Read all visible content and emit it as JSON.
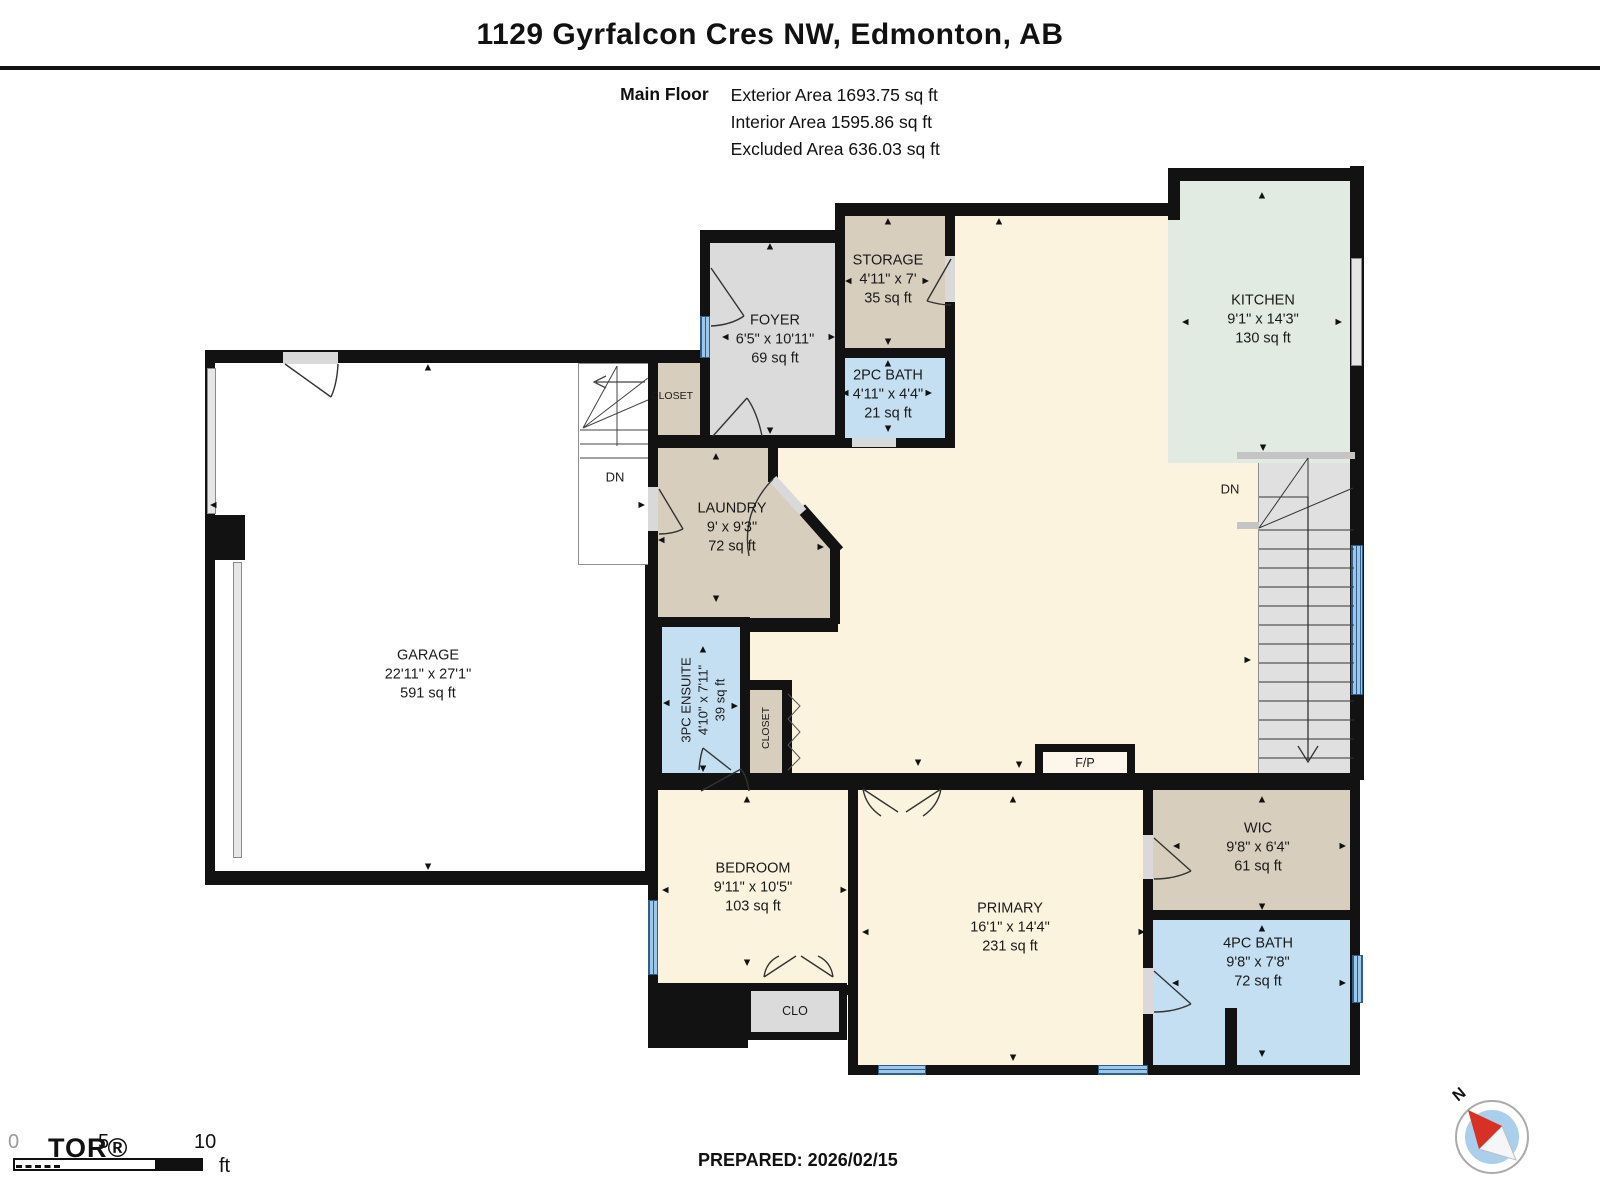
{
  "header": {
    "title": "1129 Gyrfalcon Cres NW, Edmonton, AB",
    "floor_label": "Main Floor",
    "areas": [
      "Exterior Area 1693.75 sq ft",
      "Interior Area 1595.86 sq ft",
      "Excluded Area 636.03 sq ft"
    ]
  },
  "colors": {
    "wall": "#121212",
    "cream": "#FBF3DD",
    "tan": "#D8CEBD",
    "gray_room": "#DBDBDB",
    "blue_room": "#C4DFF1",
    "mint": "#E1EBE2",
    "stairs": "#E0E0E0",
    "window_blue": "#9CC7E8"
  },
  "plan": {
    "rooms": [
      {
        "id": "family-base",
        "x": 845,
        "y": 203,
        "w": 420,
        "h": 585,
        "fill": "#FBF3DD",
        "b": [
          13,
          0,
          0,
          0
        ],
        "label": null
      },
      {
        "id": "family-west-base",
        "x": 648,
        "y": 438,
        "w": 300,
        "h": 350,
        "fill": "#FBF3DD",
        "b": [
          0,
          0,
          0,
          10
        ],
        "label": null
      },
      {
        "id": "garage",
        "x": 205,
        "y": 350,
        "w": 450,
        "h": 535,
        "fill": "#FFFFFF",
        "b": [
          13,
          10,
          14,
          10
        ],
        "label": {
          "name": "GARAGE",
          "dims": "22'11\" x 27'1\"",
          "area": "591 sq ft",
          "cx": 428,
          "cy": 675
        }
      },
      {
        "id": "garage-stairs",
        "x": 578,
        "y": 363,
        "w": 72,
        "h": 202,
        "fill": "#FFFFFF",
        "thin": true,
        "label": null
      },
      {
        "id": "stairs-down",
        "x": 1258,
        "y": 455,
        "w": 97,
        "h": 330,
        "fill": "#E0E0E0",
        "thin": true,
        "label": null
      },
      {
        "id": "kitchen",
        "x": 1168,
        "y": 168,
        "w": 192,
        "h": 295,
        "fill": "#E1EBE2",
        "b": [
          13,
          10,
          0,
          0
        ],
        "label": {
          "name": "KITCHEN",
          "dims": "9'1\" x 14'3\"",
          "area": "130 sq ft",
          "cx": 1263,
          "cy": 320
        }
      },
      {
        "id": "foyer",
        "x": 700,
        "y": 230,
        "w": 145,
        "h": 215,
        "fill": "#DBDBDB",
        "b": [
          13,
          10,
          10,
          10
        ],
        "label": {
          "name": "FOYER",
          "dims": "6'5\" x 10'11\"",
          "area": "69 sq ft",
          "cx": 775,
          "cy": 340
        }
      },
      {
        "id": "foyer-closet",
        "x": 648,
        "y": 350,
        "w": 52,
        "h": 95,
        "fill": "#D8CEBD",
        "b": [
          13,
          0,
          10,
          10
        ],
        "label": null
      },
      {
        "id": "storage",
        "x": 835,
        "y": 203,
        "w": 120,
        "h": 155,
        "fill": "#D8CEBD",
        "b": [
          13,
          10,
          10,
          10
        ],
        "label": {
          "name": "STORAGE",
          "dims": "4'11\" x 7'",
          "area": "35 sq ft",
          "cx": 888,
          "cy": 280
        }
      },
      {
        "id": "bath-2pc",
        "x": 835,
        "y": 348,
        "w": 120,
        "h": 100,
        "fill": "#C4DFF1",
        "b": [
          10,
          10,
          10,
          10
        ],
        "label": {
          "name": "2PC BATH",
          "dims": "4'11\" x 4'4\"",
          "area": "21 sq ft",
          "cx": 888,
          "cy": 395
        }
      },
      {
        "id": "laundry",
        "x": 648,
        "y": 438,
        "w": 190,
        "h": 194,
        "fill": "#D8CEBD",
        "b": [
          10,
          0,
          14,
          10
        ],
        "label": {
          "name": "LAUNDRY",
          "dims": "9' x 9'3\"",
          "area": "72 sq ft",
          "cx": 732,
          "cy": 528
        }
      },
      {
        "id": "ensuite-3pc",
        "x": 652,
        "y": 617,
        "w": 98,
        "h": 160,
        "fill": "#C4DFF1",
        "b": [
          10,
          10,
          0,
          10
        ],
        "label": {
          "name": "3PC ENSUITE",
          "dims": "4'10\" x 7'11\"",
          "area": "39 sq ft",
          "cx": 703,
          "cy": 700,
          "rot": true
        }
      },
      {
        "id": "closet-small",
        "x": 740,
        "y": 680,
        "w": 52,
        "h": 97,
        "fill": "#D8CEBD",
        "b": [
          10,
          10,
          0,
          10
        ],
        "label": null
      },
      {
        "id": "bedroom",
        "x": 648,
        "y": 780,
        "w": 210,
        "h": 215,
        "fill": "#FBF3DD",
        "b": [
          10,
          10,
          10,
          10
        ],
        "label": {
          "name": "BEDROOM",
          "dims": "9'11\" x 10'5\"",
          "area": "103 sq ft",
          "cx": 753,
          "cy": 888
        }
      },
      {
        "id": "primary",
        "x": 848,
        "y": 780,
        "w": 305,
        "h": 295,
        "fill": "#FBF3DD",
        "b": [
          10,
          10,
          10,
          10
        ],
        "label": {
          "name": "PRIMARY",
          "dims": "16'1\" x 14'4\"",
          "area": "231 sq ft",
          "cx": 1010,
          "cy": 928
        }
      },
      {
        "id": "wic",
        "x": 1143,
        "y": 780,
        "w": 217,
        "h": 140,
        "fill": "#D8CEBD",
        "b": [
          10,
          10,
          10,
          10
        ],
        "label": {
          "name": "WIC",
          "dims": "9'8\" x 6'4\"",
          "area": "61 sq ft",
          "cx": 1258,
          "cy": 848
        }
      },
      {
        "id": "bath-4pc",
        "x": 1143,
        "y": 910,
        "w": 217,
        "h": 165,
        "fill": "#C4DFF1",
        "b": [
          10,
          10,
          10,
          10
        ],
        "label": {
          "name": "4PC BATH",
          "dims": "9'8\" x 7'8\"",
          "area": "72 sq ft",
          "cx": 1258,
          "cy": 963
        }
      },
      {
        "id": "clo",
        "x": 743,
        "y": 983,
        "w": 104,
        "h": 57,
        "fill": "#DBDBDB",
        "b": [
          8,
          8,
          8,
          8
        ],
        "label": null
      },
      {
        "id": "fireplace",
        "x": 1035,
        "y": 744,
        "w": 100,
        "h": 40,
        "fill": "#FCF7EA",
        "b": [
          8,
          8,
          8,
          8
        ],
        "label": null
      }
    ],
    "walls": [
      {
        "x": 1168,
        "y": 168,
        "w": 12,
        "h": 52
      },
      {
        "x": 1350,
        "y": 166,
        "w": 14,
        "h": 614
      },
      {
        "x": 648,
        "y": 773,
        "w": 712,
        "h": 16
      },
      {
        "x": 205,
        "y": 515,
        "w": 40,
        "h": 45
      },
      {
        "x": 648,
        "y": 983,
        "w": 100,
        "h": 65
      },
      {
        "x": 1225,
        "y": 1008,
        "w": 12,
        "h": 62
      },
      {
        "x": 768,
        "y": 438,
        "w": 10,
        "h": 44
      },
      {
        "x": 830,
        "y": 548,
        "w": 10,
        "h": 76
      },
      {
        "x": 1237,
        "y": 452,
        "w": 118,
        "h": 7,
        "fill": "#C4C4C4"
      },
      {
        "x": 1237,
        "y": 522,
        "w": 22,
        "h": 7,
        "fill": "#C4C4C4"
      }
    ],
    "windows": [
      {
        "x": 700,
        "y": 316,
        "w": 10,
        "h": 42,
        "t": "blue"
      },
      {
        "x": 1351,
        "y": 258,
        "w": 11,
        "h": 108,
        "t": "grayw"
      },
      {
        "x": 1351,
        "y": 545,
        "w": 12,
        "h": 150,
        "t": "blue"
      },
      {
        "x": 648,
        "y": 900,
        "w": 10,
        "h": 75,
        "t": "blue"
      },
      {
        "x": 878,
        "y": 1065,
        "w": 48,
        "h": 10,
        "t": "blueh"
      },
      {
        "x": 1098,
        "y": 1065,
        "w": 50,
        "h": 10,
        "t": "blueh"
      },
      {
        "x": 1352,
        "y": 955,
        "w": 11,
        "h": 48,
        "t": "blue"
      },
      {
        "x": 207,
        "y": 368,
        "w": 9,
        "h": 146,
        "t": "grayw"
      },
      {
        "x": 233,
        "y": 562,
        "w": 9,
        "h": 296,
        "t": "grayw"
      },
      {
        "x": 283,
        "y": 352,
        "w": 55,
        "h": 12,
        "t": "grayd"
      },
      {
        "x": 852,
        "y": 438,
        "w": 44,
        "h": 9,
        "t": "grayd"
      },
      {
        "x": 945,
        "y": 256,
        "w": 10,
        "h": 46,
        "t": "grayd"
      },
      {
        "x": 648,
        "y": 487,
        "w": 10,
        "h": 44,
        "t": "grayd"
      },
      {
        "x": 1143,
        "y": 835,
        "w": 10,
        "h": 44,
        "t": "grayd"
      },
      {
        "x": 1143,
        "y": 968,
        "w": 10,
        "h": 46,
        "t": "grayd"
      }
    ],
    "labels": [
      {
        "text": "DN",
        "x": 615,
        "y": 477,
        "size": 13
      },
      {
        "text": "DN",
        "x": 1230,
        "y": 489,
        "size": 13
      },
      {
        "text": "CLOSET",
        "x": 672,
        "y": 396,
        "size": 10.5
      },
      {
        "text": "CLOSET",
        "x": 766,
        "y": 728,
        "size": 10.5,
        "rot": true
      },
      {
        "text": "CLO",
        "x": 795,
        "y": 1011,
        "size": 12.5
      },
      {
        "text": "F/P",
        "x": 1085,
        "y": 763,
        "size": 12.5
      }
    ],
    "arrows": [
      {
        "x": 770,
        "y": 247,
        "d": "u"
      },
      {
        "x": 726,
        "y": 337,
        "d": "l"
      },
      {
        "x": 831,
        "y": 337,
        "d": "r"
      },
      {
        "x": 770,
        "y": 430,
        "d": "d"
      },
      {
        "x": 888,
        "y": 222,
        "d": "u"
      },
      {
        "x": 849,
        "y": 281,
        "d": "l"
      },
      {
        "x": 925,
        "y": 281,
        "d": "r"
      },
      {
        "x": 888,
        "y": 341,
        "d": "d"
      },
      {
        "x": 888,
        "y": 364,
        "d": "u"
      },
      {
        "x": 846,
        "y": 393,
        "d": "l"
      },
      {
        "x": 928,
        "y": 393,
        "d": "r"
      },
      {
        "x": 888,
        "y": 428,
        "d": "d"
      },
      {
        "x": 1262,
        "y": 196,
        "d": "u"
      },
      {
        "x": 1186,
        "y": 322,
        "d": "l"
      },
      {
        "x": 1338,
        "y": 322,
        "d": "r"
      },
      {
        "x": 1263,
        "y": 447,
        "d": "d"
      },
      {
        "x": 716,
        "y": 457,
        "d": "u"
      },
      {
        "x": 662,
        "y": 540,
        "d": "l"
      },
      {
        "x": 820,
        "y": 547,
        "d": "r"
      },
      {
        "x": 716,
        "y": 598,
        "d": "d"
      },
      {
        "x": 999,
        "y": 222,
        "d": "u"
      },
      {
        "x": 1247,
        "y": 660,
        "d": "r"
      },
      {
        "x": 1019,
        "y": 764,
        "d": "d"
      },
      {
        "x": 918,
        "y": 762,
        "d": "d"
      },
      {
        "x": 428,
        "y": 368,
        "d": "u"
      },
      {
        "x": 214,
        "y": 505,
        "d": "l"
      },
      {
        "x": 641,
        "y": 505,
        "d": "r"
      },
      {
        "x": 428,
        "y": 866,
        "d": "d"
      },
      {
        "x": 703,
        "y": 650,
        "d": "u"
      },
      {
        "x": 667,
        "y": 703,
        "d": "l"
      },
      {
        "x": 734,
        "y": 706,
        "d": "r"
      },
      {
        "x": 703,
        "y": 768,
        "d": "d"
      },
      {
        "x": 747,
        "y": 800,
        "d": "u"
      },
      {
        "x": 666,
        "y": 890,
        "d": "l"
      },
      {
        "x": 843,
        "y": 890,
        "d": "r"
      },
      {
        "x": 747,
        "y": 962,
        "d": "d"
      },
      {
        "x": 1013,
        "y": 800,
        "d": "u"
      },
      {
        "x": 866,
        "y": 932,
        "d": "l"
      },
      {
        "x": 1141,
        "y": 932,
        "d": "r"
      },
      {
        "x": 1013,
        "y": 1057,
        "d": "d"
      },
      {
        "x": 1262,
        "y": 800,
        "d": "u"
      },
      {
        "x": 1177,
        "y": 846,
        "d": "l"
      },
      {
        "x": 1342,
        "y": 846,
        "d": "r"
      },
      {
        "x": 1262,
        "y": 906,
        "d": "d"
      },
      {
        "x": 1262,
        "y": 929,
        "d": "u"
      },
      {
        "x": 1176,
        "y": 983,
        "d": "l"
      },
      {
        "x": 1342,
        "y": 983,
        "d": "r"
      },
      {
        "x": 1262,
        "y": 1053,
        "d": "d"
      }
    ]
  },
  "footer": {
    "prepared": "PREPARED: 2026/02/15",
    "scale": {
      "zero": "0",
      "five": "5",
      "ten": "10",
      "unit": "ft"
    },
    "watermark": "TOR®",
    "compass_n": "N"
  }
}
